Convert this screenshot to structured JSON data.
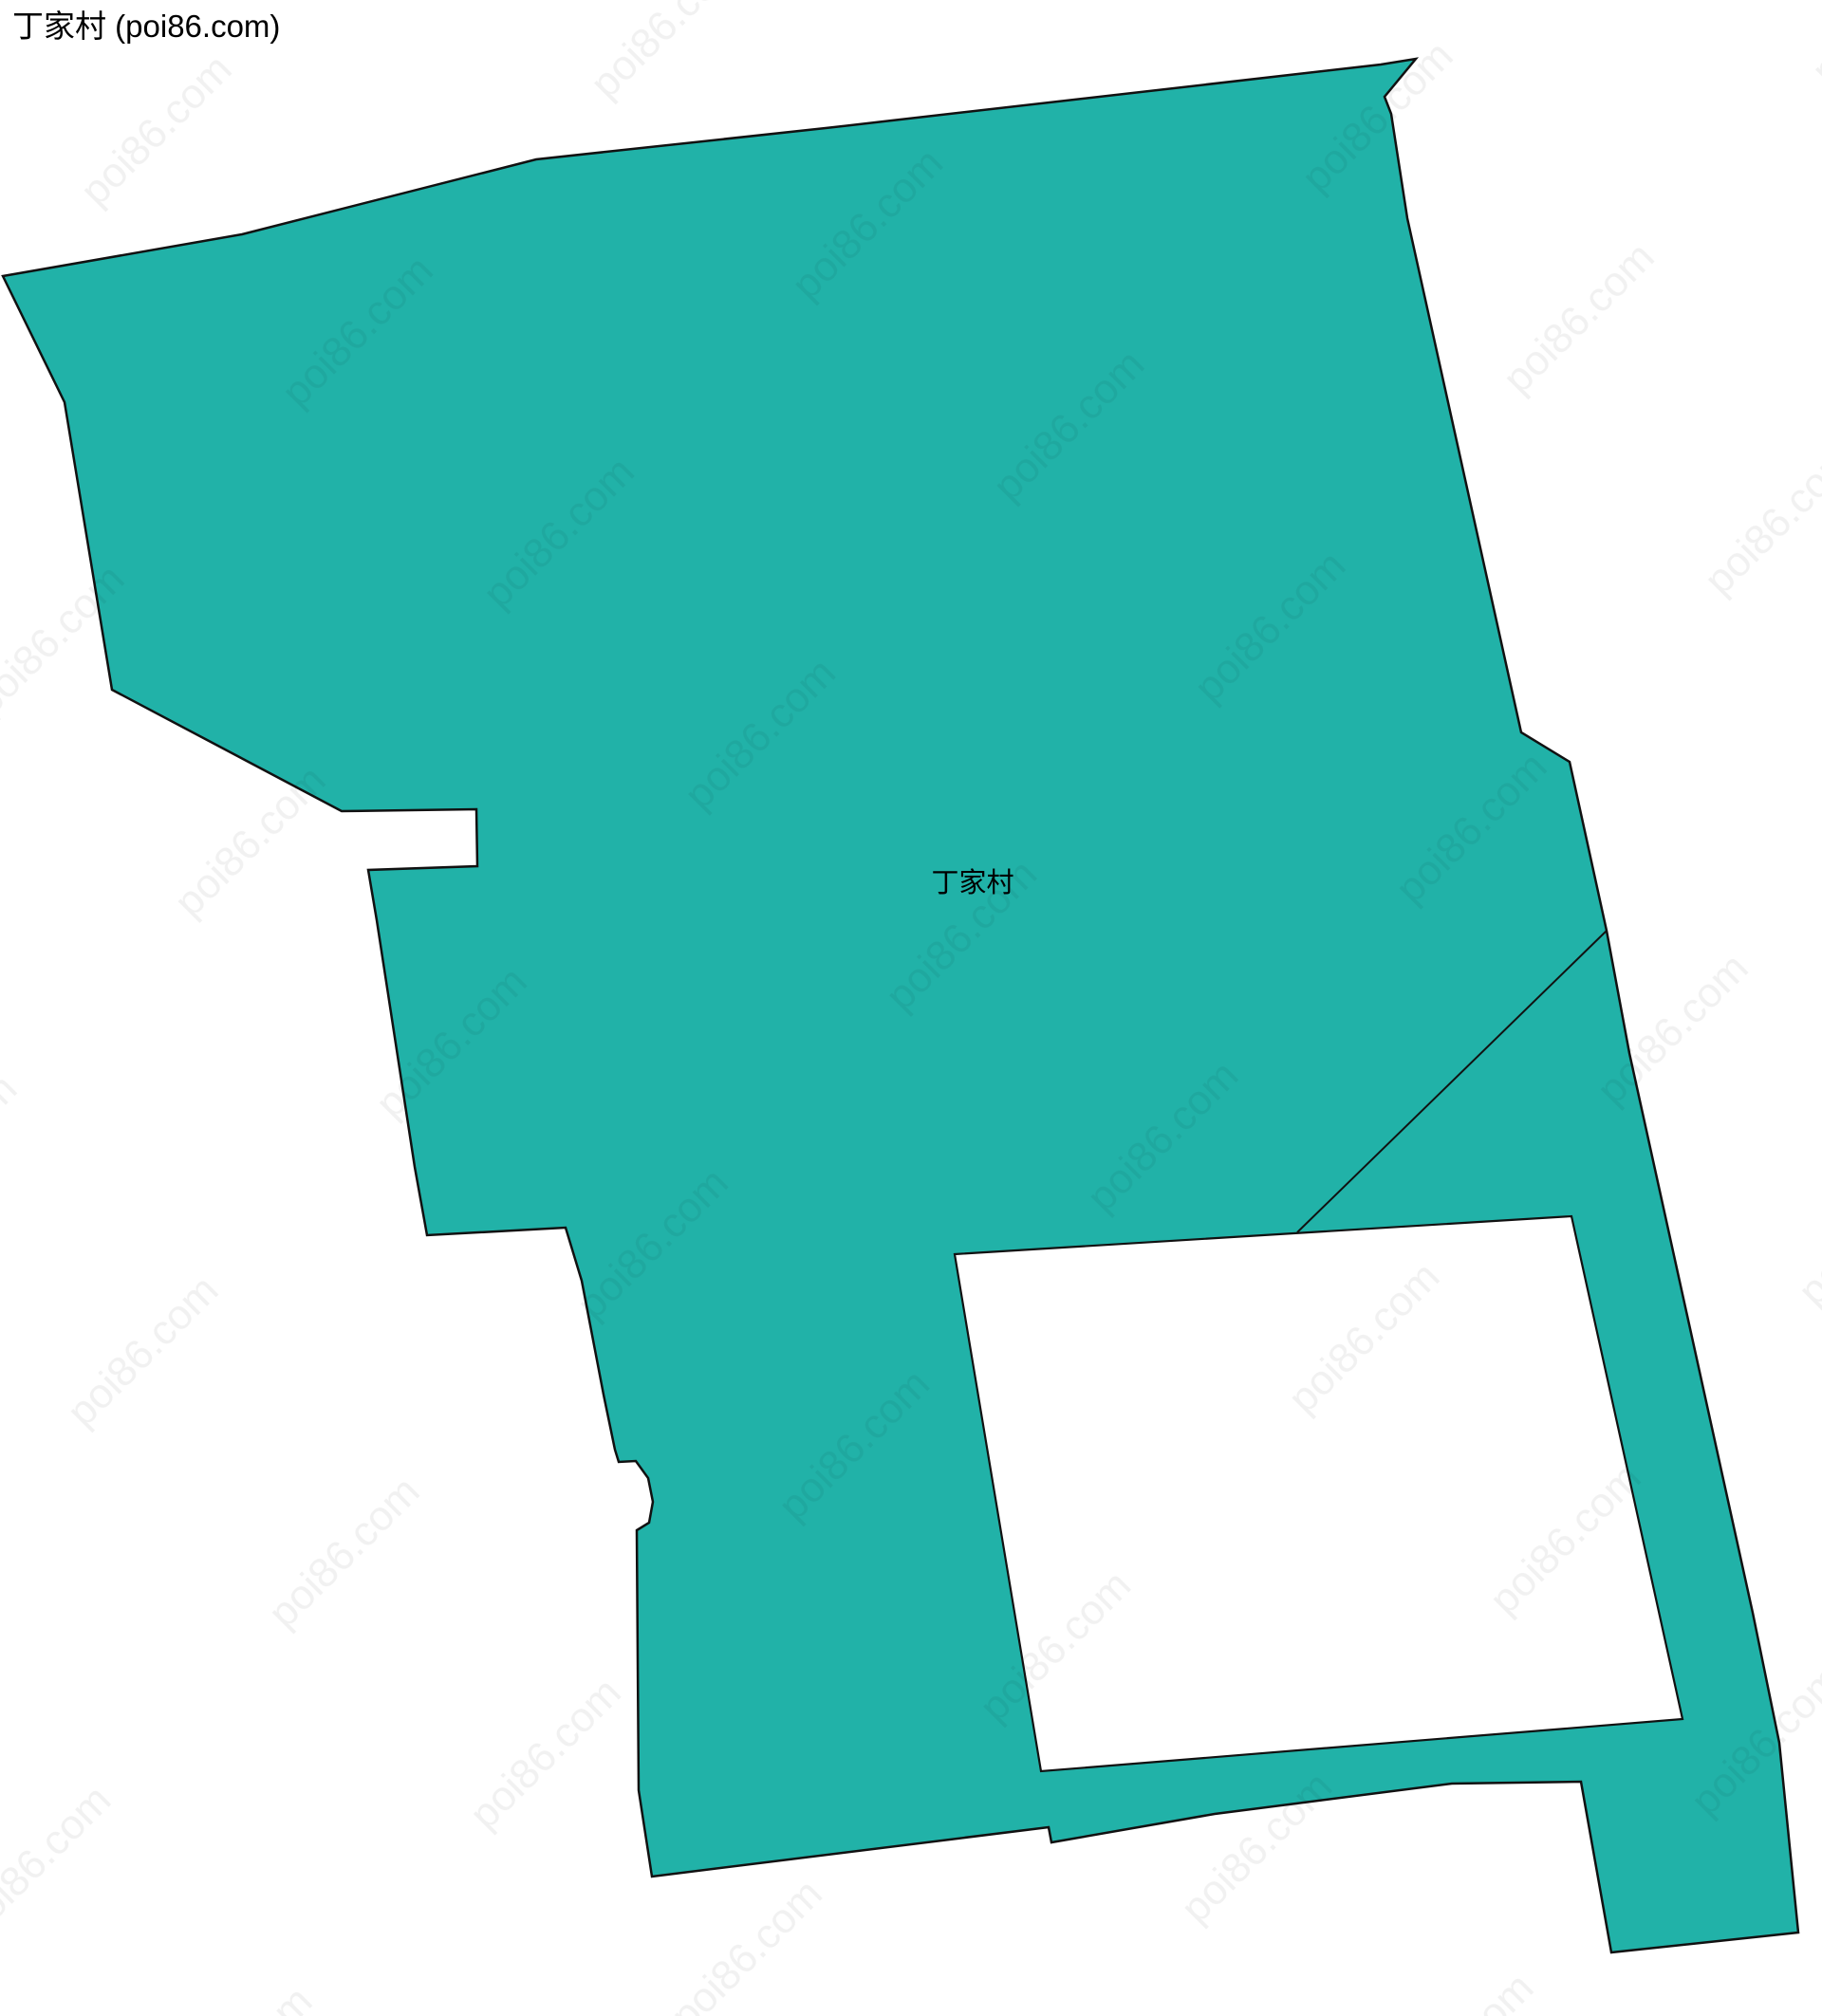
{
  "page": {
    "title": "丁家村 (poi86.com)",
    "map_label": "丁家村",
    "watermark": "poi86.com",
    "colors": {
      "background": "#ffffff",
      "region_fill": "#21b2a8",
      "region_border": "#111111",
      "hole_fill": "#ffffff",
      "label_color": "#000000",
      "watermark_color": "#000000"
    }
  }
}
